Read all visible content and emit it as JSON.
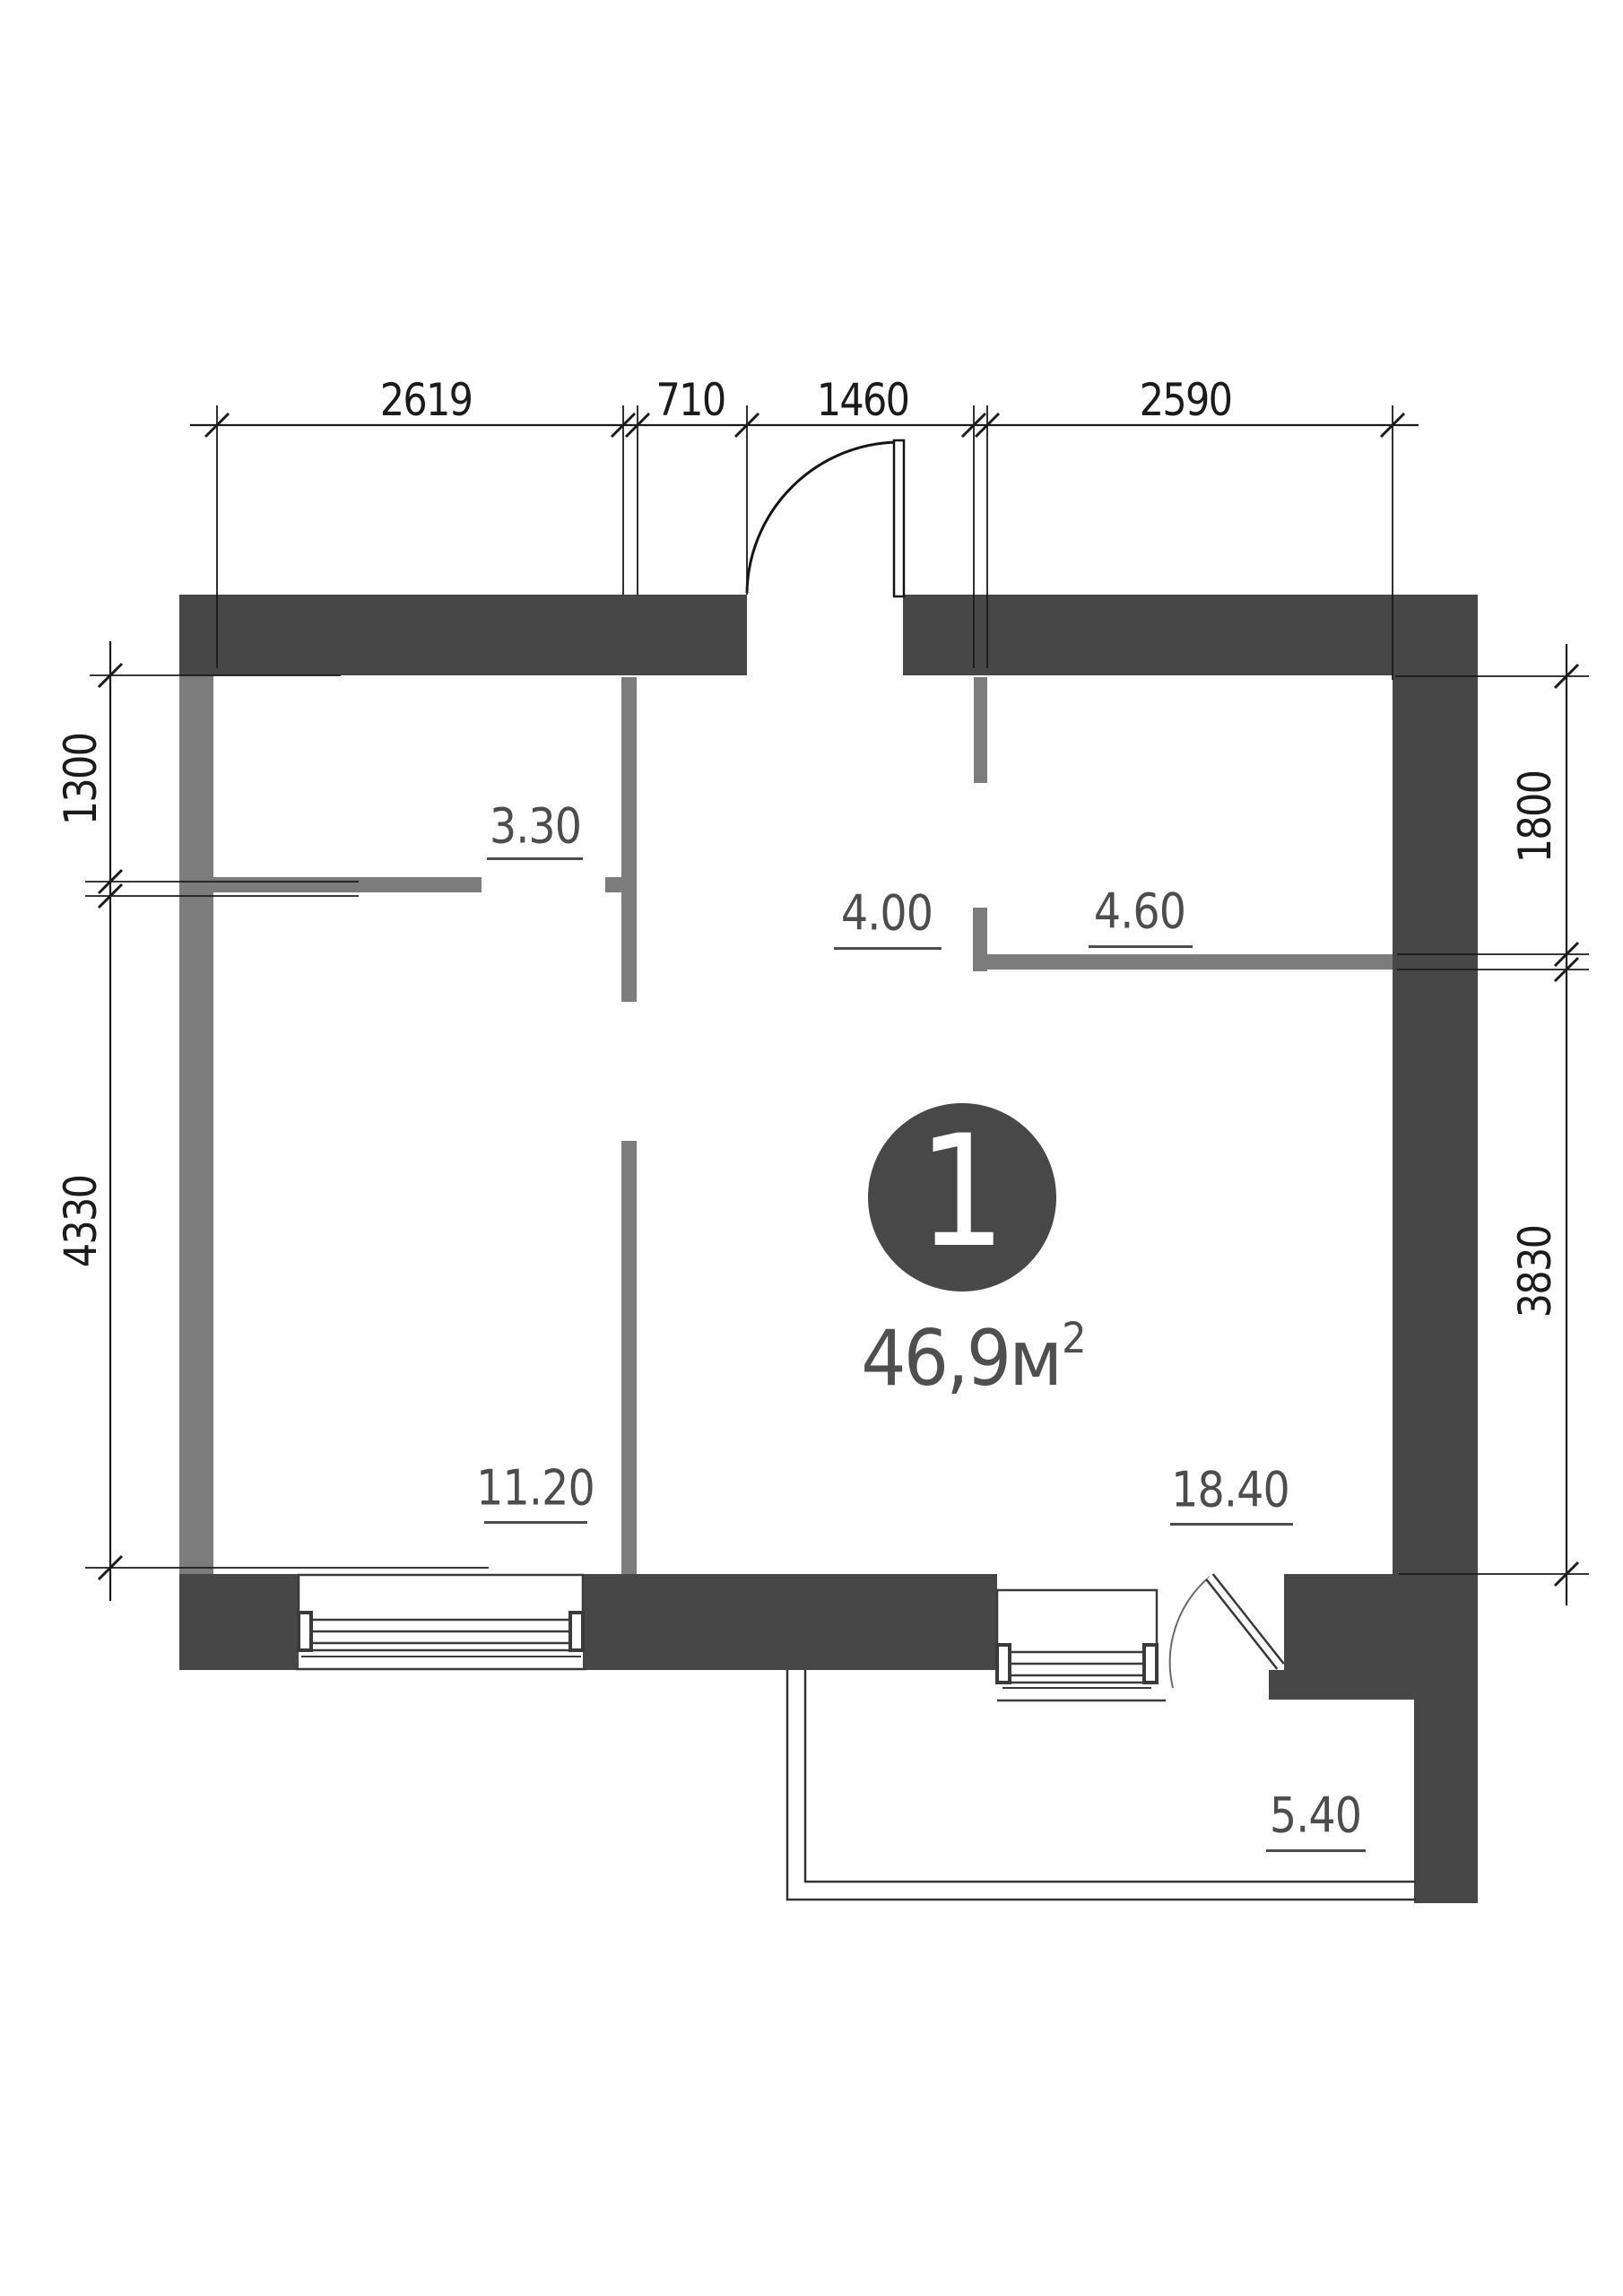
{
  "plan": {
    "unit_number": "1",
    "area": {
      "value": "46,9",
      "unit": "м",
      "superscript": "2"
    }
  },
  "rooms": [
    {
      "name": "hallway-top-left",
      "area_label": "3.30"
    },
    {
      "name": "entry-hall",
      "area_label": "4.00"
    },
    {
      "name": "kitchen",
      "area_label": "4.60"
    },
    {
      "name": "bedroom",
      "area_label": "11.20"
    },
    {
      "name": "living-room",
      "area_label": "18.40"
    },
    {
      "name": "balcony",
      "area_label": "5.40"
    }
  ],
  "dimensions": {
    "top": [
      "2619",
      "710",
      "1460",
      "2590"
    ],
    "left": [
      "1300",
      "4330"
    ],
    "right": [
      "1800",
      "3830"
    ]
  },
  "colors": {
    "wall_load_bearing": "#474747",
    "wall_partition": "#7c7c7c",
    "dimension_line": "#1b1b1b",
    "room_label": "#4d4d4d",
    "background": "#ffffff"
  }
}
